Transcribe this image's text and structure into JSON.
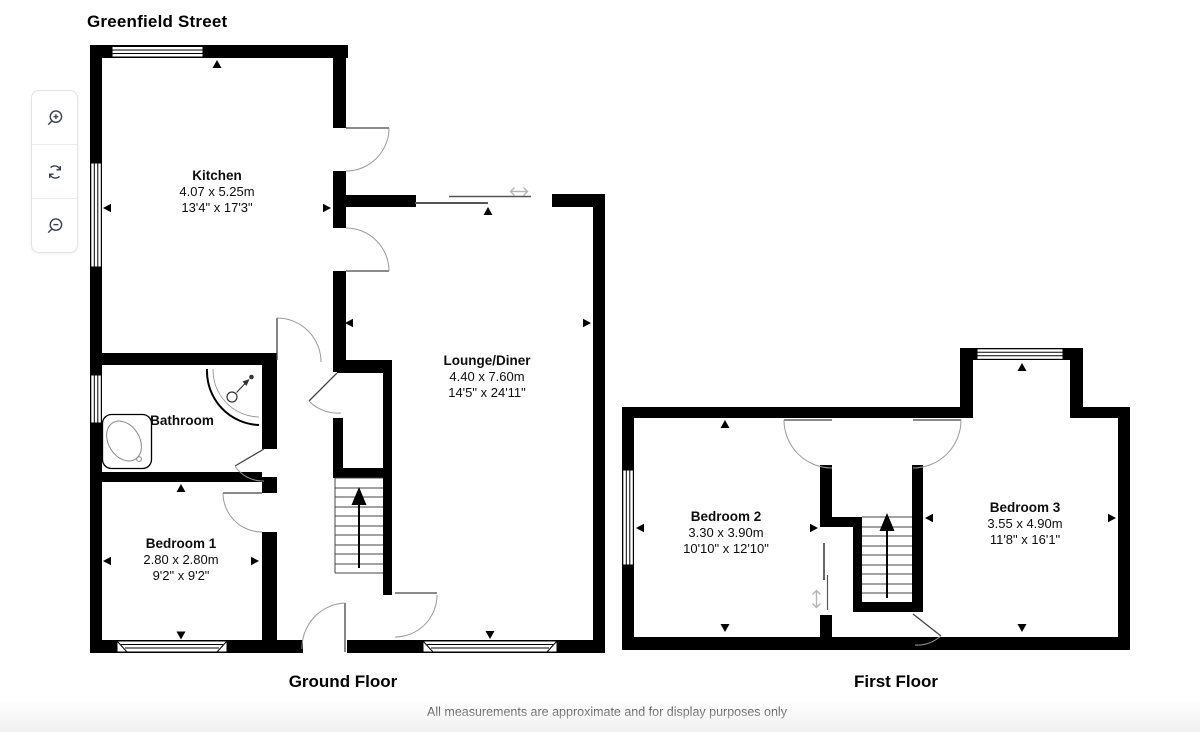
{
  "title": "Greenfield Street",
  "disclaimer": "All measurements are approximate and for display purposes only",
  "toolbar": {
    "buttons": [
      {
        "id": "zoom-in",
        "icon": "magnifier-plus-icon"
      },
      {
        "id": "rotate",
        "icon": "rotate-arrows-icon"
      },
      {
        "id": "zoom-out",
        "icon": "magnifier-minus-icon"
      }
    ]
  },
  "floors": [
    {
      "label": "Ground Floor",
      "rooms": [
        {
          "name": "Kitchen",
          "metric": "4.07 x 5.25m",
          "imperial": "13'4\" x 17'3\""
        },
        {
          "name": "Lounge/Diner",
          "metric": "4.40 x 7.60m",
          "imperial": "14'5\" x 24'11\""
        },
        {
          "name": "Bathroom",
          "metric": "",
          "imperial": ""
        },
        {
          "name": "Bedroom 1",
          "metric": "2.80 x 2.80m",
          "imperial": "9'2\" x 9'2\""
        }
      ]
    },
    {
      "label": "First Floor",
      "rooms": [
        {
          "name": "Bedroom 2",
          "metric": "3.30 x 3.90m",
          "imperial": "10'10\" x 12'10\""
        },
        {
          "name": "Bedroom 3",
          "metric": "3.55 x 4.90m",
          "imperial": "11'8\" x 16'1\""
        }
      ]
    }
  ],
  "colors": {
    "wall": "#000000",
    "arc": "#9a9a9a",
    "slider_symbol": "#b5b5b5",
    "icon": "#3a4150",
    "fade": "#f0f0f0"
  }
}
